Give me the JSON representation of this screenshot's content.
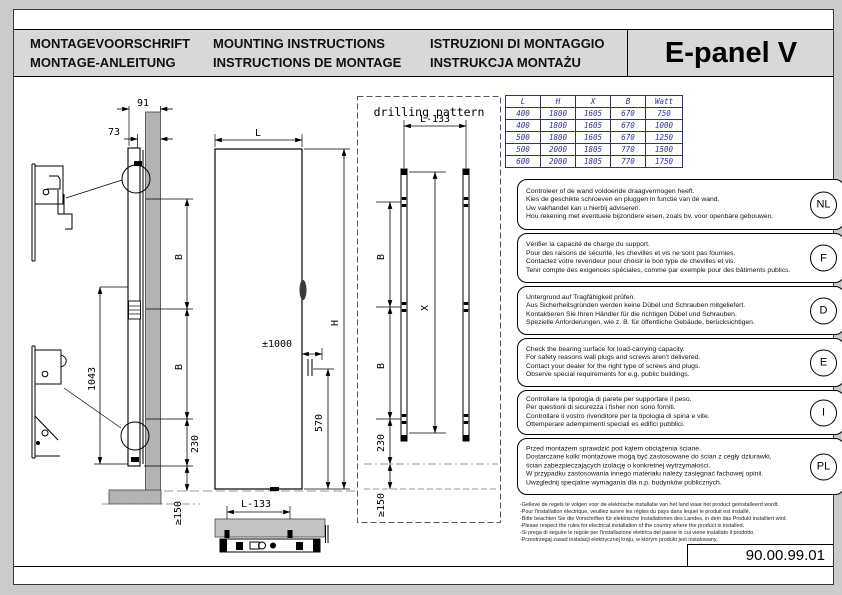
{
  "header": {
    "titles": [
      {
        "line1": "MONTAGEVOORSCHRIFT",
        "line2": "MONTAGE-ANLEITUNG"
      },
      {
        "line1": "MOUNTING INSTRUCTIONS",
        "line2": "INSTRUCTIONS DE MONTAGE"
      },
      {
        "line1": "ISTRUZIONI DI MONTAGGIO",
        "line2": "INSTRUKCJA MONTAŻU"
      }
    ],
    "product": "E-panel V"
  },
  "spec_table": {
    "headers": [
      "L",
      "H",
      "X",
      "B",
      "Watt"
    ],
    "rows": [
      [
        "400",
        "1800",
        "1605",
        "670",
        "750"
      ],
      [
        "400",
        "1800",
        "1605",
        "670",
        "1000"
      ],
      [
        "500",
        "1800",
        "1605",
        "670",
        "1250"
      ],
      [
        "500",
        "2000",
        "1805",
        "770",
        "1500"
      ],
      [
        "600",
        "2000",
        "1805",
        "770",
        "1750"
      ]
    ]
  },
  "drawing": {
    "pattern_title": "drilling pattern",
    "side_view": {
      "d91": "91",
      "d73": "73",
      "dB1": "B",
      "dB2": "B",
      "d1043": "1043",
      "d230": "230",
      "d150": "≥150"
    },
    "front_view": {
      "dL": "L",
      "dH": "H",
      "dCable": "±1000",
      "d570": "570"
    },
    "bottom_view": {
      "dL133": "L-133"
    },
    "pattern": {
      "dL133": "L-133",
      "dX": "X",
      "dB1": "B",
      "dB2": "B",
      "d230": "230",
      "d150": "≥150"
    }
  },
  "instructions": [
    {
      "lang": "NL",
      "text": "Controleer of de wand voldoende draagvermogen heeft.\nKies de geschikte schroeven en pluggen in functie van de wand.\nUw vakhandel kan u hierbij adviseren.\nHou rekening met eventuele bijzondere eisen, zoals bv. voor openbare gebouwen."
    },
    {
      "lang": "F",
      "text": "Vérifier la capacité de charge du support.\nPour des raisons de sécurité, les chevilles et vis ne sont pas fournies.\nContactez votre revendeur pour choisir le bon type de chevilles et vis.\nTenir compte des exigences spéciales, comme par exemple pour des bâtiments publics."
    },
    {
      "lang": "D",
      "text": "Untergrund auf Tragfähigkeit prüfen.\nAus Sicherheitsgründen werden keine Dübel und Schrauben mitgeliefert.\nKontaktieren Sie Ihren Händler für die richtigen Dübel und Schrauben.\nSpezielle Anforderungen, wie z. B. für öffentliche Gebäude, berücksichtigen."
    },
    {
      "lang": "E",
      "text": "Check the bearing surface for load-carrying capacity.\nFor safety reasons wall plugs and screws aren't delivered.\nContact your dealer for the right type of screws and plugs.\nObserve special requirements for e.g. public buildings."
    },
    {
      "lang": "I",
      "text": "Controllare la tipologia di parete per supportare il peso.\nPer questioni di sicurezza i fisher non sono forniti.\nControllare il vostro rivenditore per la tipologia di spina e vite.\nOttemperare adempimenti speciali es edifici pubblici."
    },
    {
      "lang": "PL",
      "text": "Przed montażem sprawdzić pod kątem obciążenia ściane.\nDostarczane kolki montażowe mogą być zastosowane do ścian z cegły dziurawki,\nścian zabezpieczających izolację o konkretnej wytrzymałości.\nW przypadku zastosowania innego materiału należy zasięgnać fachowej opinii.\nUwzglednij specjalne wymagania dla n.p. budynków publicznych."
    }
  ],
  "footnotes": "-Gelieve de regels te volgen voor de elektrische installatie van het land waar het product geïnstalleerd wordt.\n-Pour l'installation électrique, veuillez suivre les règles du pays dans lequel le produit est installé.\n-Bitte beachten Sie die Vorschriften für elektrische Installationen des Landes, in dem das Produkt installiert wird.\n-Please respect the rules for electrical installation of the country where the product is installed.\n-Si prega di seguire le regole per l'installazione elettrica del paese in cui viene installato il prodotto.\n-Przestrzegaj zasad instalacji elektrycznej kraju, w którym produkt jest instalowany.",
  "doc_number": "90.00.99.01",
  "colors": {
    "table_accent": "#2e2e8f",
    "header_gray": "#d8d8d8",
    "wall_gray": "#b3b3b3"
  }
}
